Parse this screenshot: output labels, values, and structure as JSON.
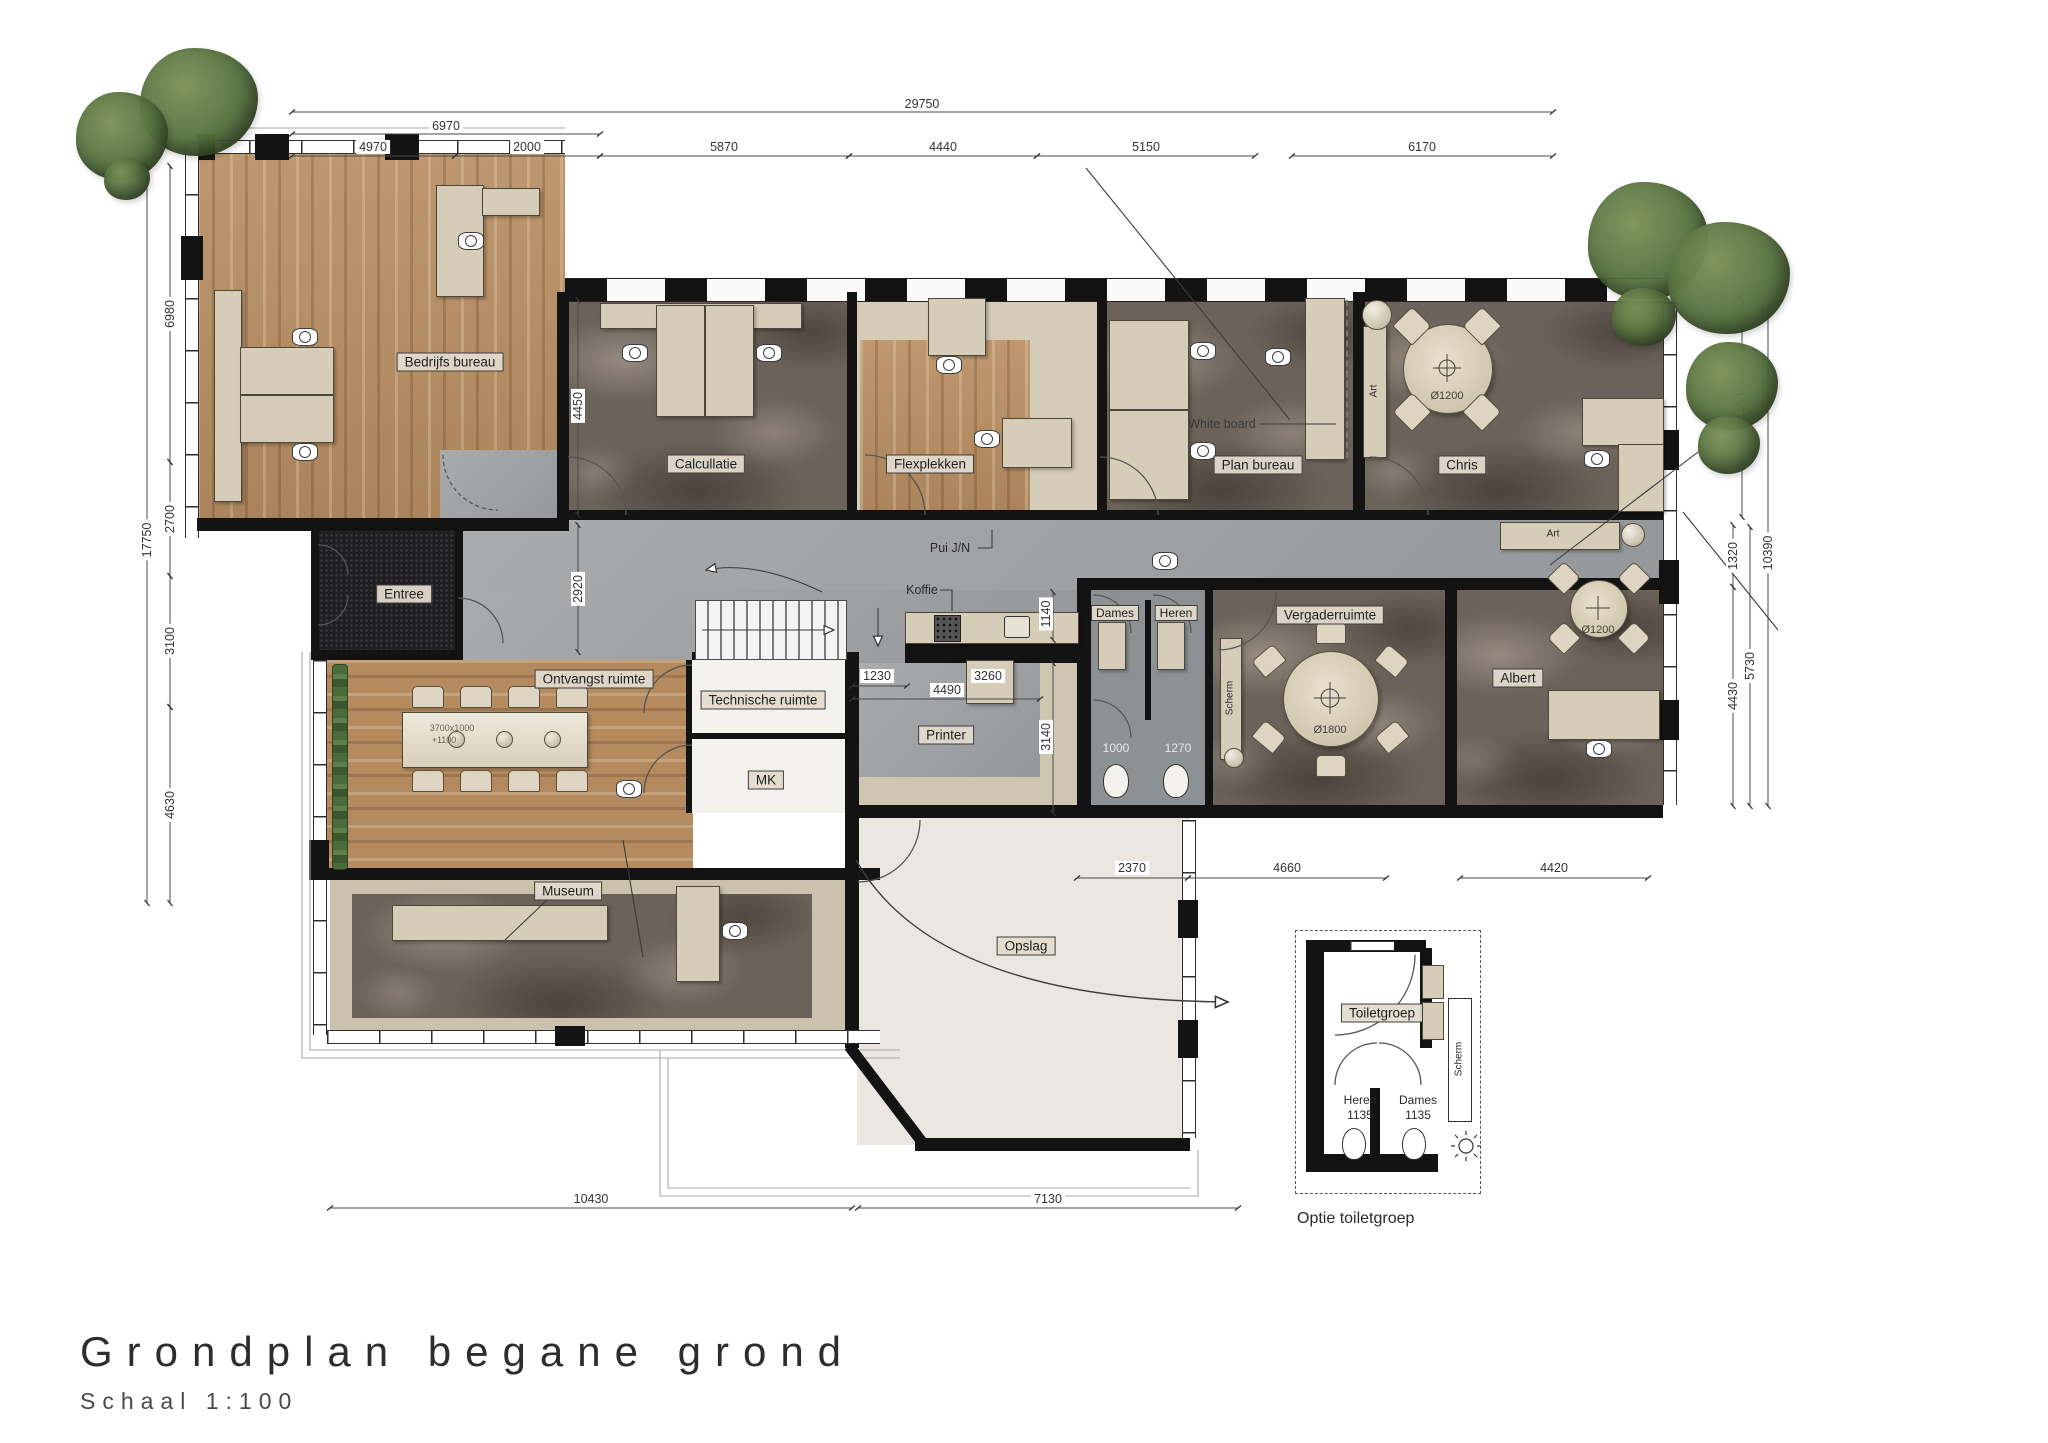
{
  "title": {
    "heading": "Grondplan begane grond",
    "subtitle": "Schaal 1:100"
  },
  "rooms": {
    "bedrijfs": "Bedrijfs bureau",
    "calculatie": "Calcullatie",
    "flexplekken": "Flexplekken",
    "plan_bureau": "Plan bureau",
    "chris": "Chris",
    "entree": "Entree",
    "ontvangst": "Ontvangst ruimte",
    "technische": "Technische ruimte",
    "mk": "MK",
    "printer": "Printer",
    "museum": "Museum",
    "opslag": "Opslag",
    "dames": "Dames",
    "heren": "Heren",
    "vergaderruimte": "Vergaderruimte",
    "albert": "Albert",
    "toiletgroep": "Toiletgroep"
  },
  "annotations": {
    "koffie": "Koffie",
    "pui": "Pui J/N",
    "whiteboard": "White board",
    "scherm": "Scherm",
    "art": "Art",
    "optie": "Optie toiletgroep",
    "table_spec": "3700x1000",
    "table_height": "+1100",
    "d1200": "Ø1200",
    "d1800": "Ø1800"
  },
  "dims": {
    "t29750": "29750",
    "t6970": "6970",
    "t4970": "4970",
    "t2000": "2000",
    "t5870": "5870",
    "t4440": "4440",
    "t5150": "5150",
    "t6170": "6170",
    "l17750": "17750",
    "l6980": "6980",
    "l2700": "2700",
    "l3100": "3100",
    "l4630": "4630",
    "r4450": "4450",
    "r1320": "1320",
    "r10390": "10390",
    "r5730": "5730",
    "r4430": "4430",
    "b10430": "10430",
    "b7130": "7130",
    "i4450": "4450",
    "i2920": "2920",
    "i1230": "1230",
    "i4490": "4490",
    "i3260": "3260",
    "i1140": "1140",
    "i3140": "3140",
    "i1000": "1000",
    "i1270": "1270",
    "i2370": "2370",
    "i4660": "4660",
    "i4420": "4420",
    "i1135": "1135"
  },
  "colors": {
    "wood": "#b98f63",
    "marble": "#6b6259",
    "corridor": "#a3a5a7",
    "entree_mat": "#1f1f22",
    "furniture": "#d6cdb9",
    "wall": "#131313",
    "tree": "#55713f",
    "opslag_floor": "#eae7e0",
    "service_floor": "#f2f1ed",
    "museum_border": "#cbc2ae",
    "toilet_floor": "#8e9194"
  }
}
